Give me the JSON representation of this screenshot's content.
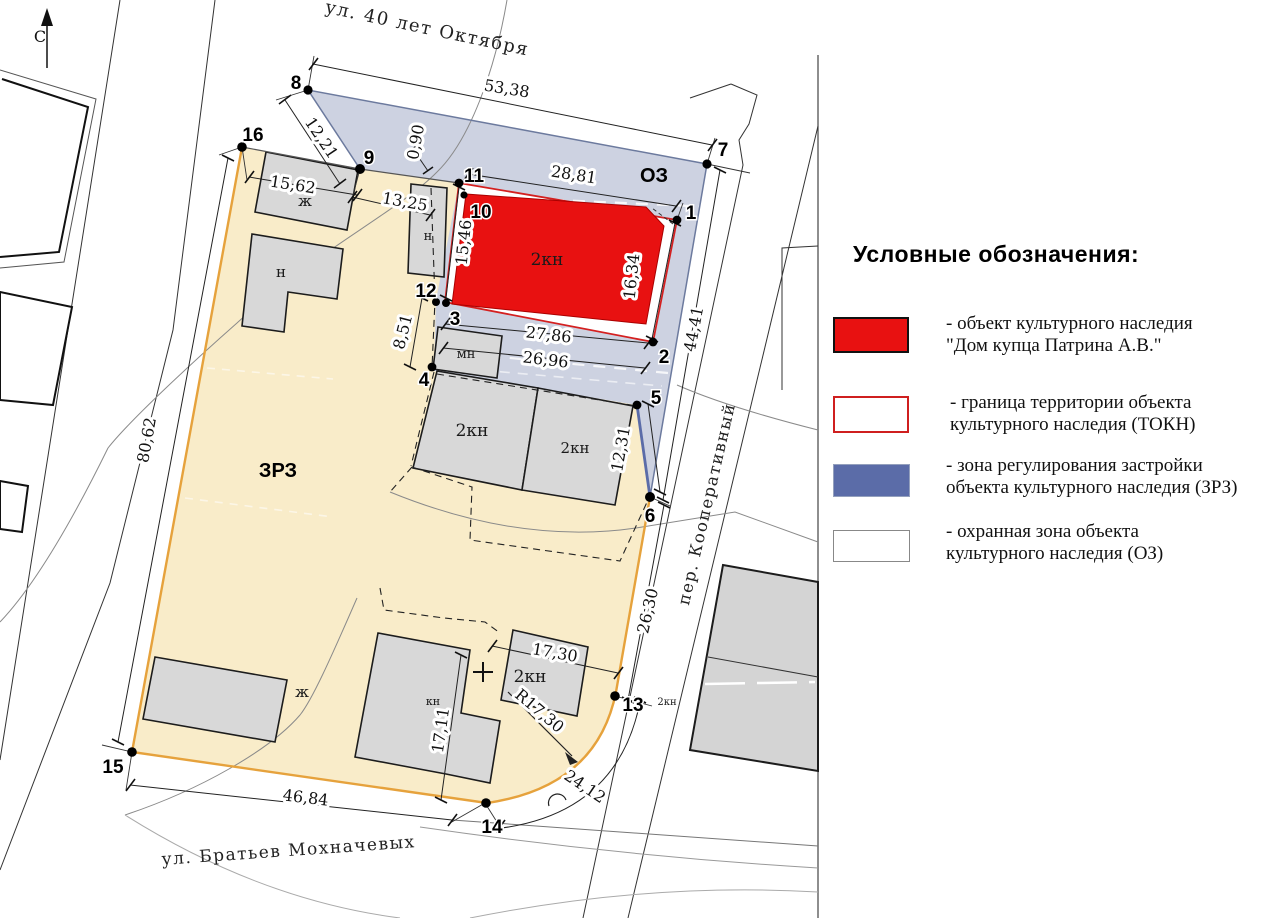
{
  "legend": {
    "title": "Условные обозначения:",
    "items": [
      {
        "id": "heritage-object",
        "line1": "- объект культурного наследия",
        "line2": "\"Дом купца Патрина А.В.\""
      },
      {
        "id": "tokn-boundary",
        "line1": "- граница территории объекта",
        "line2": "культурного наследия (ТОКН)"
      },
      {
        "id": "zrz-zone",
        "line1": "- зона регулирования застройки",
        "line2": "объекта культурного наследия (ЗРЗ)"
      },
      {
        "id": "oz-zone",
        "line1": "- охранная зона объекта",
        "line2": "культурного наследия (ОЗ)"
      }
    ]
  },
  "map": {
    "north_label": "С",
    "streets": {
      "top": "ул. 40 лет Октября",
      "right": "пер. Кооперативный",
      "bottom": "ул.  Братьев Мохначевых"
    },
    "zone_labels": {
      "oz": "ОЗ",
      "zrz": "ЗРЗ"
    },
    "points": {
      "p1": "1",
      "p2": "2",
      "p3": "3",
      "p4": "4",
      "p5": "5",
      "p6": "6",
      "p7": "7",
      "p8": "8",
      "p9": "9",
      "p10": "10",
      "p11": "11",
      "p12": "12",
      "p13": "13",
      "p14": "14",
      "p15": "15",
      "p16": "16"
    },
    "dimensions": {
      "d53_38": "53,38",
      "d12_21": "12,21",
      "d0_90": "0,90",
      "d28_81": "28,81",
      "d15_46": "15,46",
      "d16_34": "16,34",
      "d27_86": "27,86",
      "d26_96": "26,96",
      "d44_41": "44,41",
      "d12_31": "12,31",
      "d8_51": "8,51",
      "d15_62": "15,62",
      "d13_25": "13,25",
      "d80_62": "80,62",
      "d26_30": "26,30",
      "d17_30": "17,30",
      "dR17_30": "R17,30",
      "d17_11": "17,11",
      "d46_84": "46,84",
      "d24_12": "24,12"
    },
    "building_labels": {
      "main": "2кн",
      "zh_top": "ж",
      "n_top": "н",
      "n_mid": "н",
      "mn": "мн",
      "kn2_a": "2кн",
      "kn2_b": "2кн",
      "kn": "кн",
      "kn2_c": "2кн",
      "zh_bottom": "ж",
      "kn2_east": "2кн"
    },
    "colors": {
      "heritage_red": "#e81111",
      "tokn_border_red": "#d42020",
      "zrz_map_yellow": "#f9ecc9",
      "oz_map_blue": "#cdd2e1",
      "zone_edge_orange": "#e6a23c",
      "zone_edge_blue": "#5b6ca8",
      "legend_zrz_blue": "#5b6ca8"
    }
  }
}
